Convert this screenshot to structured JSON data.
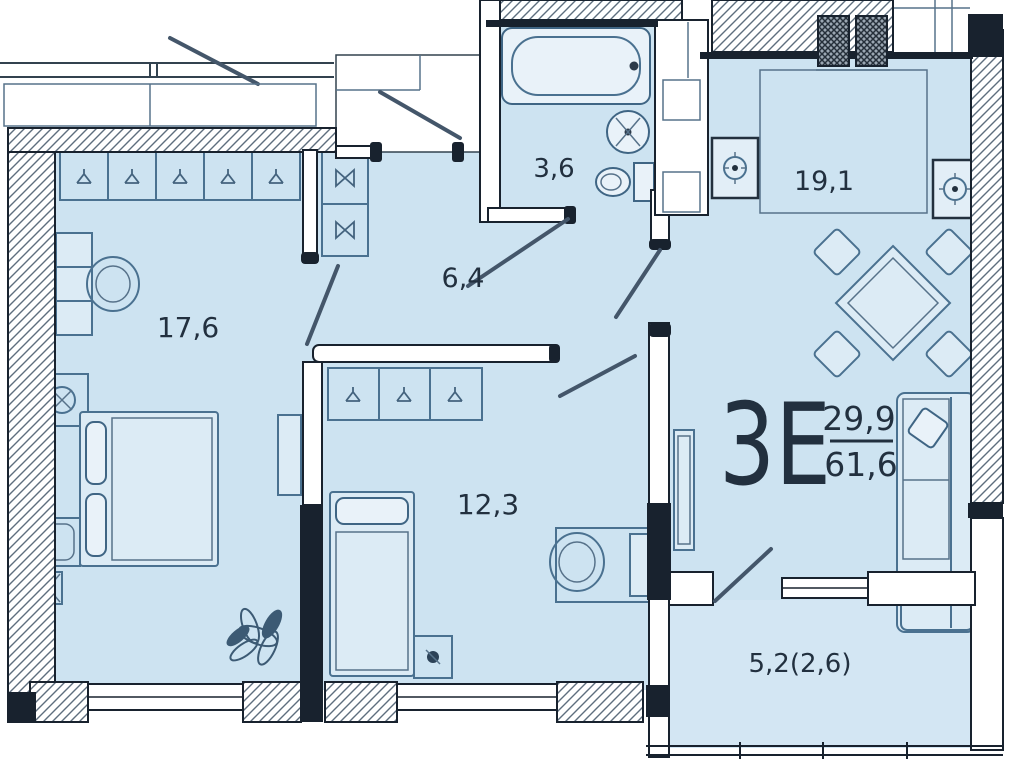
{
  "plan": {
    "title": "apartment-floor-plan",
    "apartment": {
      "type": "3Е",
      "living_area": "29,9",
      "total_area": "61,6"
    },
    "rooms": {
      "bedroom": {
        "name": "bedroom",
        "area": "17,6"
      },
      "hall": {
        "name": "hallway",
        "area": "6,4"
      },
      "bathroom": {
        "name": "bathroom",
        "area": "3,6"
      },
      "kitchen_living": {
        "name": "kitchen-living",
        "area": "19,1"
      },
      "bedroom2": {
        "name": "bedroom-2",
        "area": "12,3"
      },
      "loggia": {
        "name": "loggia",
        "area": "5,2(2,6)"
      }
    },
    "colors": {
      "floor": "#cde3f1",
      "wall": "#18222e",
      "furniture_stroke": "#4a7190",
      "label_text": "#22303f",
      "background": "#ffffff"
    },
    "icons": {
      "bathtub-icon": "bath tub with tap",
      "sink-icon": "round wash basin",
      "toilet-icon": "toilet with cistern",
      "kitchen-sink-icon": "square sink with faucet cross",
      "washer-icon": "appliance square with drum",
      "dining-table-icon": "rotated square table with four chairs",
      "sofa-icon": "corner sofa",
      "bed-icon": "double bed with pillows",
      "bed2-icon": "single bed with pillow",
      "wardrobe-hanger-icon": "hanger cell",
      "wardrobe-bowtie-icon": "sliding wardrobe cell",
      "desk-chair-icon": "desk with round chair",
      "tv-icon": "tv console",
      "plant-icon": "potted plant",
      "vent-shaft-icon": "ventilation duct block",
      "door-leaf-icon": "door swing leaf",
      "window-icon": "window in wall"
    }
  }
}
